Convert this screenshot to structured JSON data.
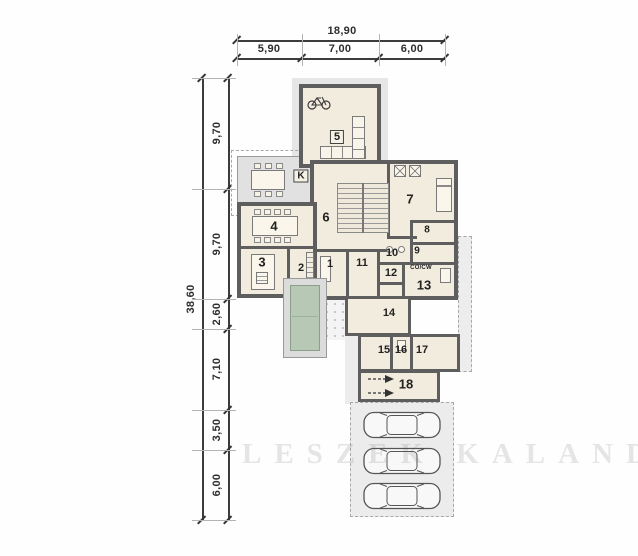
{
  "title": "House floor plan",
  "dimensions": {
    "top": {
      "total": "18,90",
      "segments": [
        "5,90",
        "7,00",
        "6,00"
      ]
    },
    "left": {
      "total": "38,60",
      "segments": [
        "9,70",
        "9,70",
        "2,60",
        "7,10",
        "3,50",
        "6,00"
      ]
    }
  },
  "rooms": [
    {
      "number": "1"
    },
    {
      "number": "2"
    },
    {
      "number": "3"
    },
    {
      "number": "4"
    },
    {
      "number": "5"
    },
    {
      "number": "6"
    },
    {
      "number": "7"
    },
    {
      "number": "8"
    },
    {
      "number": "9"
    },
    {
      "number": "10"
    },
    {
      "number": "11"
    },
    {
      "number": "12"
    },
    {
      "number": "13"
    },
    {
      "number": "14"
    },
    {
      "number": "15"
    },
    {
      "number": "16"
    },
    {
      "number": "17"
    },
    {
      "number": "18"
    }
  ],
  "labels": {
    "fireplace": "K",
    "utility": "CO/CW"
  },
  "watermark": {
    "text": "LESZEK KALANDYK"
  },
  "colors": {
    "wall": "#5e5e5e",
    "room_fill": "#f2ecdf",
    "terrace": "#e2e2e2",
    "pool": "#b7c8b5",
    "paving": "#ececec",
    "dim_text": "#2e2e2e"
  }
}
